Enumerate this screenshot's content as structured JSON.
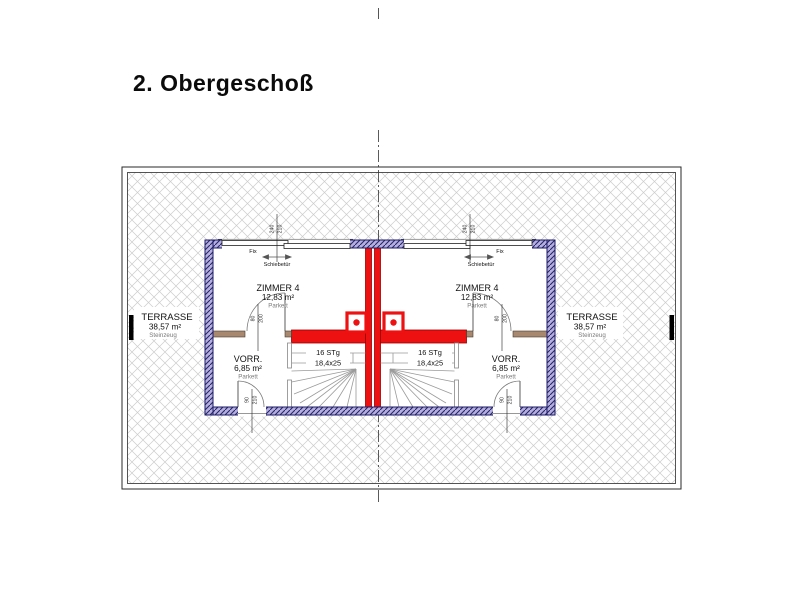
{
  "title": "2. Obergeschoß",
  "colors": {
    "exterior_wall_fill": "#b5afdd",
    "exterior_wall_line": "#1b1b66",
    "party_wall_red": "#ee1111",
    "party_wall_edge": "#990000",
    "interior_wall_brown": "#a8886f",
    "terrace_hatch": "#cccccc",
    "stair_line": "#9a9a9a",
    "muted_label": "#7a7a7a"
  },
  "plan": {
    "left_unit": {
      "room": {
        "name": "ZIMMER 4",
        "area": "12,83 m²",
        "floor": "Parkett"
      },
      "hall": {
        "name": "VORR.",
        "area": "6,85 m²",
        "floor": "Parkett"
      },
      "terrace": {
        "name": "TERRASSE",
        "area": "38,57 m²",
        "floor": "Steinzeug"
      },
      "stairs": {
        "count": "16 STg",
        "tread": "18,4x25"
      },
      "window": {
        "fixed_label": "Fix",
        "sliding_label": "Schiebetür",
        "width": "240",
        "height": "210"
      },
      "room_door": {
        "width": "80",
        "height": "200"
      },
      "terrace_door": {
        "width": "90",
        "height": "210"
      }
    },
    "right_unit": {
      "room": {
        "name": "ZIMMER 4",
        "area": "12,83 m²",
        "floor": "Parkett"
      },
      "hall": {
        "name": "VORR.",
        "area": "6,85 m²",
        "floor": "Parkett"
      },
      "terrace": {
        "name": "TERRASSE",
        "area": "38,57 m²",
        "floor": "Steinzeug"
      },
      "stairs": {
        "count": "16 STg",
        "tread": "18,4x25"
      },
      "window": {
        "fixed_label": "Fix",
        "sliding_label": "Schiebetür",
        "width": "240",
        "height": "210"
      },
      "room_door": {
        "width": "80",
        "height": "200"
      },
      "terrace_door": {
        "width": "90",
        "height": "210"
      }
    }
  }
}
